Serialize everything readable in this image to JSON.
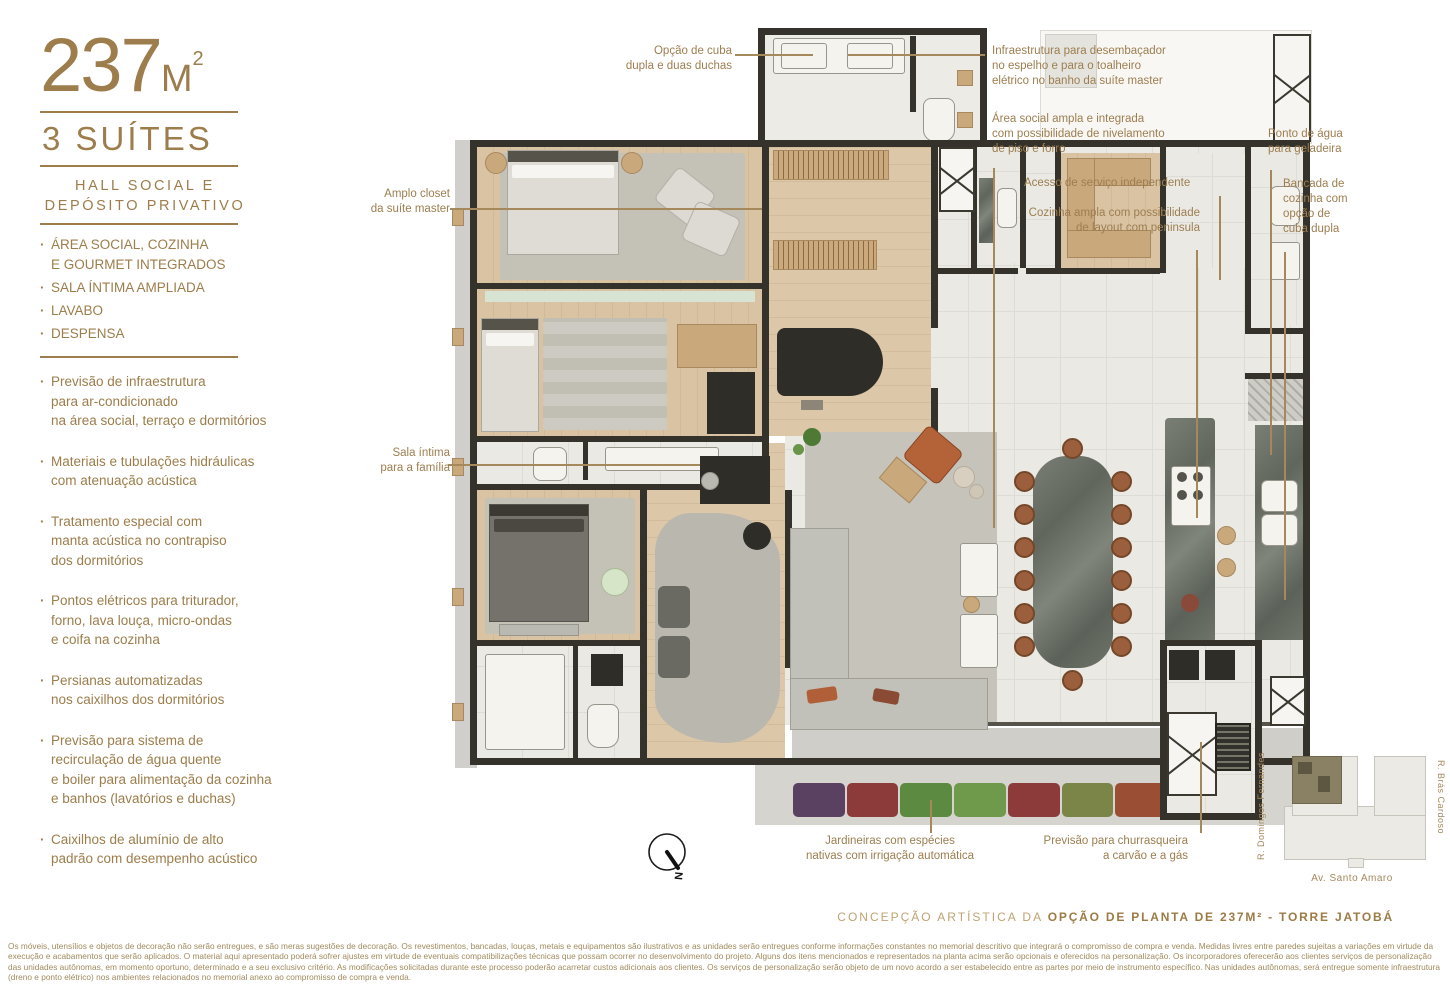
{
  "accent": {
    "gold": "#9c7d4b",
    "gold_light": "#bfa372",
    "leader": "#a5885c",
    "wall": "#34322b"
  },
  "sidebar": {
    "area_value": "237",
    "area_unit": "M",
    "area_sup": "2",
    "suites": "3 SUÍTES",
    "subtitle": "HALL SOCIAL E\nDEPÓSITO PRIVATIVO",
    "features_caps": [
      "ÁREA SOCIAL, COZINHA\nE GOURMET INTEGRADOS",
      "SALA ÍNTIMA AMPLIADA",
      "LAVABO",
      "DESPENSA"
    ],
    "features": [
      "Previsão de infraestrutura\npara ar-condicionado\nna área social, terraço  e dormitórios",
      "Materiais e tubulações hidráulicas\ncom atenuação acústica",
      "Tratamento especial com\nmanta acústica no contrapiso\ndos dormitórios",
      "Pontos elétricos para triturador,\nforno, lava louça, micro-ondas\ne coifa na cozinha",
      "Persianas automatizadas\nnos caixilhos dos dormitórios",
      "Previsão para sistema de\nrecirculação de água quente\ne boiler para alimentação da cozinha\ne banhos (lavatórios e duchas)",
      "Caixilhos de alumínio de alto\npadrão com desempenho acústico"
    ]
  },
  "callouts": {
    "cuba": {
      "text": "Opção de cuba\ndupla e duas duchas"
    },
    "infra": {
      "text": "Infraestrutura para desembaçador\nno espelho e para o toalheiro\nelétrico no banho da suíte master"
    },
    "area_social": {
      "text": "Área social ampla e integrada\ncom possibilidade de nivelamento\nde piso e forro"
    },
    "acesso": {
      "text": "Acesso de serviço independente"
    },
    "cozinha": {
      "text": "Cozinha ampla com possibilidade\nde layout com peninsula"
    },
    "ponto_agua": {
      "text": "Ponto de água\npara geladeira"
    },
    "bancada": {
      "text": "Bancada de\ncozinha com\nopção de\ncuba dupla"
    },
    "closet": {
      "text": "Amplo closet\nda suíte master"
    },
    "sala_intima": {
      "text": "Sala íntima\npara a família"
    },
    "jardineiras": {
      "text": "Jardineiras com espécies\nnativas com irrigação automática"
    },
    "churrasqueira": {
      "text": "Previsão para churrasqueira\na carvão e a gás"
    }
  },
  "compass": {
    "letter": "N"
  },
  "plan": {
    "planter_colors": [
      "#5a4162",
      "#8d3a3b",
      "#5d8a41",
      "#6f9a4c",
      "#8d3a3b",
      "#7a8547",
      "#9a4f35"
    ]
  },
  "keyplan": {
    "street_left": "R. Domingos Fernandes",
    "street_right": "R. Brás Cardoso",
    "street_bottom": "Av. Santo Amaro"
  },
  "caption": {
    "light": "CONCEPÇÃO ARTÍSTICA DA ",
    "bold": "OPÇÃO DE PLANTA DE 237M² - TORRE JATOBÁ"
  },
  "disclaimer": "Os móveis, utensílios e objetos de decoração não serão entregues, e são meras sugestões de decoração. Os revestimentos, bancadas, louças, metais e equipamentos são ilustrativos e as unidades serão entregues conforme informações constantes no memorial descritivo que integrará o compromisso de compra e venda. Medidas livres entre paredes sujeitas a variações em virtude da execução e acabamentos que serão aplicados. O material aqui apresentado poderá sofrer ajustes em virtude de eventuais compatibilizações técnicas que possam ocorrer no desenvolvimento do projeto. Alguns dos itens mencionados e representados na planta acima serão opcionais e oferecidos na personalização. Os incorporadores oferecerão aos clientes serviços de personalização das unidades autônomas, em momento oportuno, determinado e a seu exclusivo critério. As modificações solicitadas durante este processo poderão acarretar custos adicionais aos clientes. Os serviços de personalização serão objeto de um novo acordo a ser estabelecido entre as partes por meio de instrumento específico. Nas unidades autônomas, será entregue somente infraestrutura (dreno e ponto elétrico) nos ambientes relacionados no memorial anexo ao compromisso de compra e venda."
}
